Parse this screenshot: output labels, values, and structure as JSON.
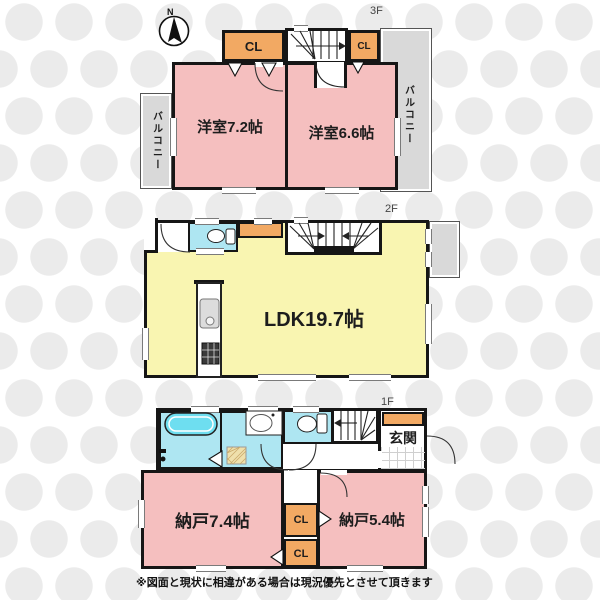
{
  "compass": {
    "north": "N"
  },
  "floor3": {
    "label": "3F",
    "room_west": "洋室7.2帖",
    "room_east": "洋室6.6帖",
    "closet_left": "CL",
    "closet_right": "CL",
    "balcony_left": "バルコニー",
    "balcony_right": "バルコニー"
  },
  "floor2": {
    "label": "2F",
    "ldk": "LDK19.7帖"
  },
  "floor1": {
    "label": "1F",
    "entrance": "玄関",
    "storage_west": "納戸7.4帖",
    "storage_east": "納戸5.4帖",
    "closet_upper": "CL",
    "closet_lower": "CL"
  },
  "footer": {
    "disclaimer": "※図面と現状に相違がある場合は現況優先とさせて頂きます"
  },
  "colors": {
    "room_pink": "#F5BFBF",
    "ldk_yellow": "#F9F5B1",
    "closet_orange": "#F2A963",
    "water_blue": "#AEE6F2",
    "balcony_gray": "#D9D9D9",
    "bathtub_cyan": "#6EDEF0",
    "wall_black": "#161616"
  }
}
